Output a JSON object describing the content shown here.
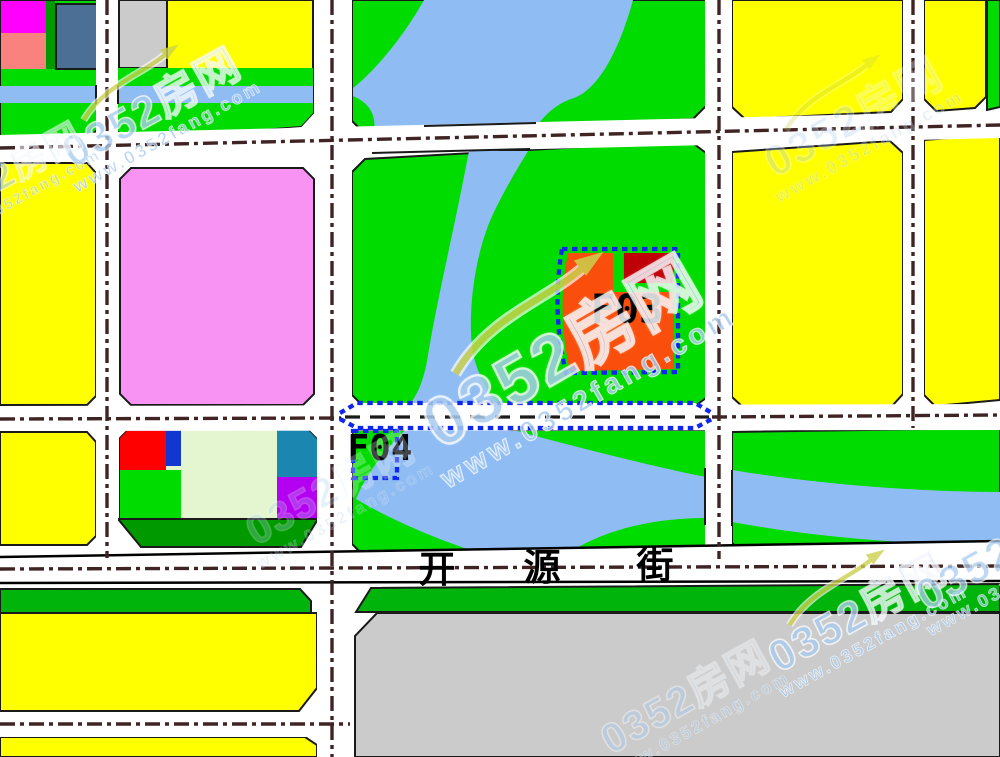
{
  "map": {
    "street_name": "开源街",
    "street_chars": [
      "开",
      "源",
      "街"
    ],
    "parcels": {
      "f03_label": "F03",
      "f04_label": "F04"
    }
  },
  "watermark": {
    "brand": "0352房网",
    "url": "www.0352fang.com"
  },
  "colors": {
    "white": "#FFFFFF",
    "yellow": "#FFFF00",
    "green": "#00DC00",
    "green_med": "#00B40B",
    "green_dark": "#009A00",
    "green_pale": "#E3F6CF",
    "gray": "#CBCBCB",
    "river": "#8FBCF2",
    "pink": "#F893F4",
    "magenta": "#FF00FF",
    "salmon": "#F9827F",
    "slate": "#4C6F96",
    "red": "#FF0000",
    "navy": "#1236CF",
    "teal": "#1B87B0",
    "purple": "#B400F0",
    "orange": "#F94E0C",
    "dark_red": "#C00007",
    "outline": "#1A1A1A",
    "road_line": "#402424",
    "corridor_line": "#1B1B1B",
    "blue_dash": "#1026EE",
    "wm_blue": "#A9CCEF",
    "wm_swoosh": "#CBD14D"
  }
}
